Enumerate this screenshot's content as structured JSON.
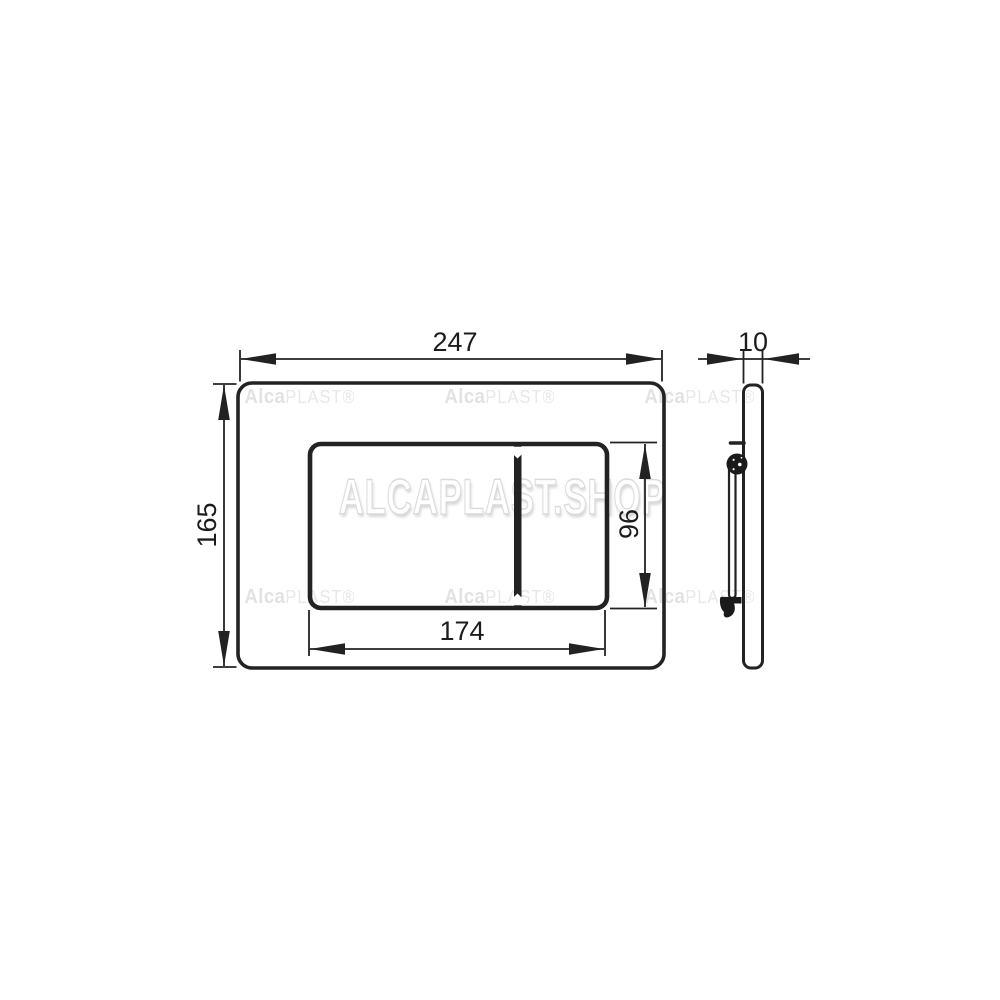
{
  "dimensions": {
    "plate_width": "247",
    "plate_height": "165",
    "buttons_width": "174",
    "buttons_height": "96",
    "plate_depth": "10"
  },
  "watermarks": {
    "tile_bold": "Alca",
    "tile_light": "PLAST®",
    "center": "ALCAPLAST.SHOP"
  },
  "colors": {
    "line": "#222222",
    "dimension_text": "#1c1c1c",
    "watermark_tile": "#e6e6e6",
    "background": "#ffffff"
  }
}
